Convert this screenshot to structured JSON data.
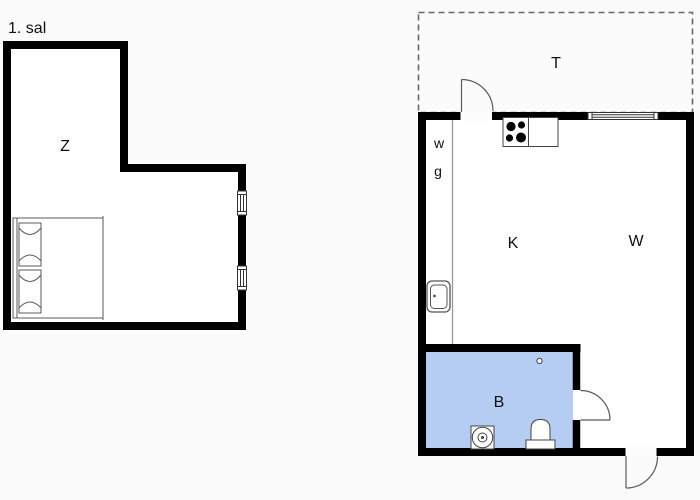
{
  "page": {
    "floor_label": "1. sal"
  },
  "colors": {
    "wall": "#000000",
    "background": "#fbfbfb",
    "room_fill": "#ffffff",
    "bathroom_fill": "#b5cdf2",
    "fixture_line": "#4a4a4a",
    "partition_line": "#9a9a9a",
    "terrace_dash": "#666666"
  },
  "upper_floor_plan": {
    "floor_label": "1. sal",
    "rooms": [
      {
        "key": "bedroom",
        "label": "Z"
      }
    ],
    "fixtures": [
      {
        "key": "double-bed"
      },
      {
        "key": "window-upper"
      },
      {
        "key": "window-lower"
      }
    ]
  },
  "ground_floor_plan": {
    "rooms": [
      {
        "key": "terrace",
        "label": "T"
      },
      {
        "key": "kitchen",
        "label": "K"
      },
      {
        "key": "living-room",
        "label": "W"
      },
      {
        "key": "bathroom",
        "label": "B"
      },
      {
        "key": "wardrobe-w",
        "label": "w"
      },
      {
        "key": "wardrobe-g",
        "label": "g"
      }
    ],
    "fixtures": [
      {
        "key": "terrace-door"
      },
      {
        "key": "stove"
      },
      {
        "key": "kitchen-window"
      },
      {
        "key": "kitchen-sink"
      },
      {
        "key": "floor-drain"
      },
      {
        "key": "washing-machine"
      },
      {
        "key": "toilet"
      },
      {
        "key": "bathroom-door"
      },
      {
        "key": "entry-door"
      }
    ]
  }
}
